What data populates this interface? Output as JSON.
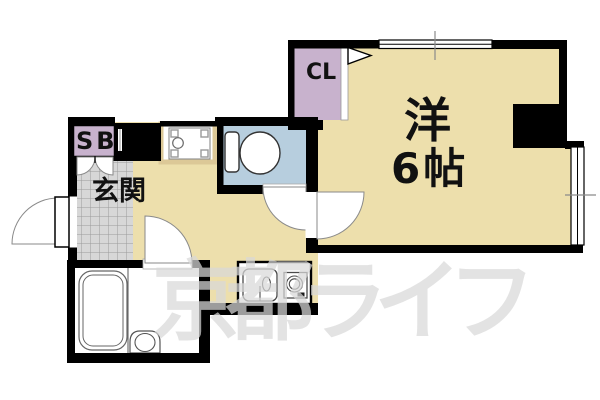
{
  "floorplan": {
    "western_room": {
      "label": "洋",
      "size": "6帖"
    },
    "closet": {
      "label": "CL"
    },
    "entrance": {
      "label": "玄関"
    },
    "shoe_box": {
      "label": "SB"
    },
    "watermark": "京都ライフ",
    "colors": {
      "floor-beige": "#EDDFAC",
      "closet-purple": "#C8B2CD",
      "toilet-blue": "#B7CEDE",
      "tile-gray": "#D7D7D7",
      "wall-black": "#000000",
      "pan-tan": "#DCC897",
      "watermark-gray": "#D9D9D9"
    }
  }
}
